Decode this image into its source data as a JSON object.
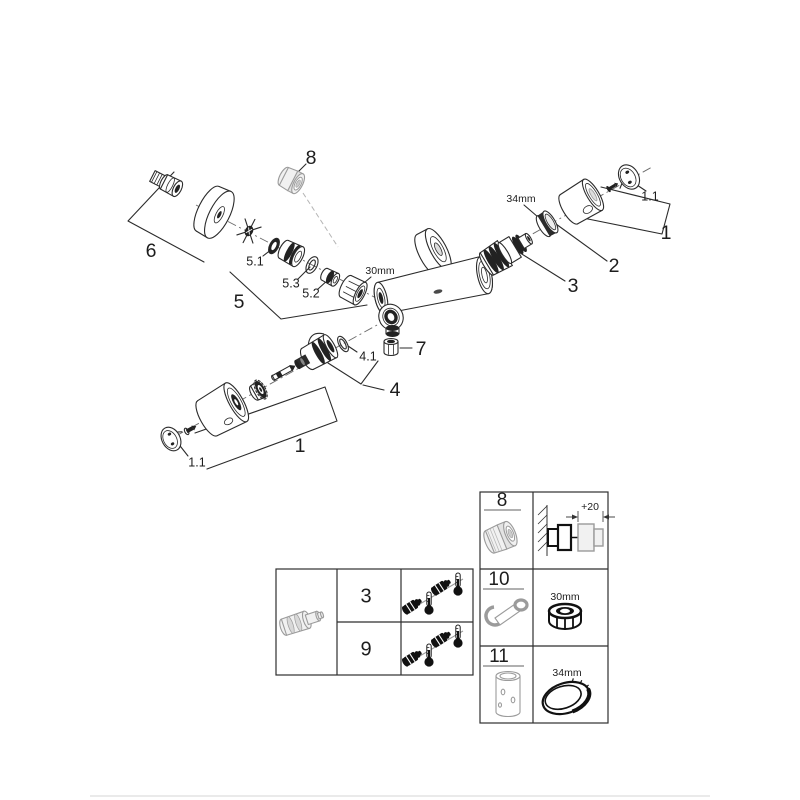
{
  "style": {
    "ink_color": "#2b2b2b",
    "grey_part_color": "#9b9b9b",
    "background": "#ffffff"
  },
  "diagram": {
    "labels": {
      "p8": "8",
      "p6": "6",
      "p51": "5.1",
      "p53": "5.3",
      "p52": "5.2",
      "p5": "5",
      "nut30": "30mm",
      "ring34": "34mm",
      "p11_right": "1.1",
      "p1_right": "1",
      "p2": "2",
      "p3": "3",
      "p7": "7",
      "p41": "4.1",
      "p4": "4",
      "p1_lower": "1",
      "p11_lower": "1.1"
    }
  },
  "left_table": {
    "rows": [
      {
        "ref": "3"
      },
      {
        "ref": "9"
      }
    ]
  },
  "right_table": {
    "rows": [
      {
        "ref": "8",
        "dim": "+20"
      },
      {
        "ref": "10",
        "dim": "30mm"
      },
      {
        "ref": "11",
        "dim": "34mm"
      }
    ]
  }
}
